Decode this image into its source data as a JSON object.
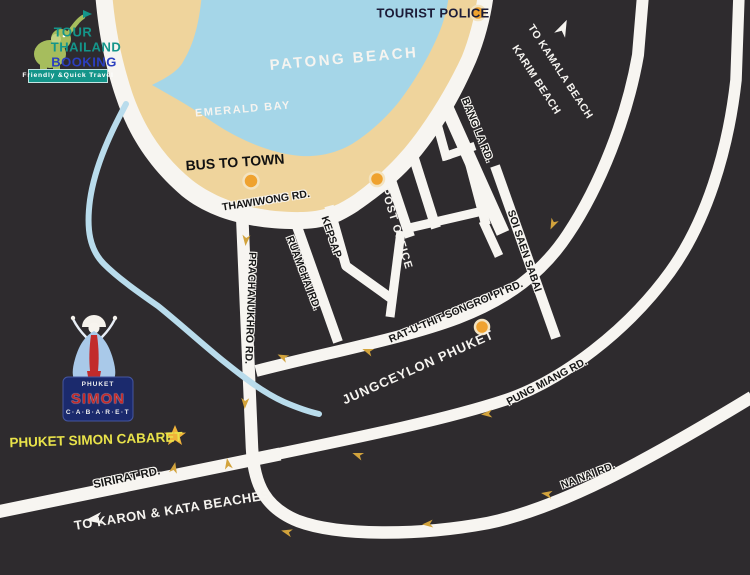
{
  "brand": {
    "line1": "TOUR",
    "line2": "THAILAND",
    "line3": "BOOKING",
    "tagline": "Friendly &Quick Travel"
  },
  "areas": {
    "patong_beach": "PATONG BEACH",
    "emerald_bay": "EMERALD BAY"
  },
  "pois": {
    "tourist_police": "TOURIST POLICE",
    "bus_to_town": "BUS TO TOWN",
    "post_office": "POST OFFICE",
    "jungceylon": "JUNGCEYLON PHUKET",
    "simon_cabaret": "PHUKET SIMON CABARET"
  },
  "roads": {
    "thawiwong": "THAWIWONG RD.",
    "prachanukhro": "PRACHANUKHRO RD.",
    "ruamchai": "RUAMCHAI RD.",
    "kepsap": "KEPSAP",
    "bang_la": "BANG LA RD.",
    "soi_saen_sabai": "SOI SAEN SABAI",
    "rat_u_thit": "RAT-U-THIT SONGROI PI RD.",
    "pung_miang": "PUNG MIANG RD.",
    "na_nai": "NA NAI RD.",
    "sirirat": "SIRIRAT RD."
  },
  "directions": {
    "kamala_line1": "TO KAMALA BEACH",
    "kamala_line2": "KARIM BEACH",
    "karon": "TO KARON & KATA BEACHES"
  },
  "cabaret_logo": {
    "top": "PHUKET",
    "name": "SIMON",
    "letters": "C·A·B·A·R·E·T"
  },
  "colors": {
    "background": "#2e2b2e",
    "road": "#f7f5f1",
    "water": "#a5d6e8",
    "sand": "#efd49c",
    "stream": "#b9dcec",
    "marker": "#efa22f",
    "marker_ring": "#f3e3c0",
    "arrow_gold": "#d2a33c",
    "star_yellow": "#f0b23a",
    "cabaret_yellow": "#e9e34a",
    "navy_text": "#1c1c38",
    "brand_teal": "#14958a",
    "brand_blue": "#2b3fbf",
    "brand_green": "#a6bd5d",
    "cabaret_navy": "#1b2a6d",
    "cabaret_red": "#c22b2b",
    "cabaret_gown": "#a9c9e9"
  }
}
